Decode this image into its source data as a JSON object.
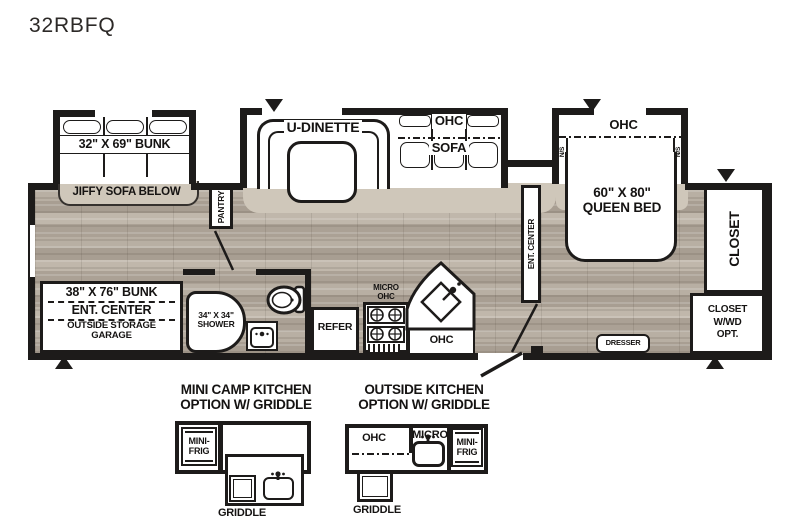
{
  "title": "32RBFQ",
  "plan": {
    "bunk_slide_label": "32\" X 69\" BUNK",
    "jiffy_sofa_label": "JIFFY SOFA BELOW",
    "pantry_label": "PANTRY",
    "udinette_label": "U-DINETTE",
    "sofa_ohc_label": "OHC",
    "sofa_label": "SOFA",
    "bed_ohc_label": "OHC",
    "ns_left_label": "N/S",
    "ns_right_label": "N/S",
    "queen_size_label": "60\" X 80\"",
    "queen_label": "QUEEN BED",
    "closet_label": "CLOSET",
    "closet_wwd_line1": "CLOSET",
    "closet_wwd_line2": "W/WD",
    "closet_wwd_line3": "OPT.",
    "garage_line1": "38\" X 76\" BUNK",
    "garage_line2": "ENT. CENTER",
    "garage_line3": "OUTSIDE STORAGE",
    "garage_line4": "GARAGE",
    "shower_line1": "34\" X 34\"",
    "shower_line2": "SHOWER",
    "refer_label": "REFER",
    "micro_line1": "MICRO",
    "micro_line2": "OHC",
    "kitchen_ohc_label": "OHC",
    "ent_center_label": "ENT. CENTER",
    "dresser_label": "DRESSER"
  },
  "options": {
    "mini_camp": {
      "title_line1": "MINI CAMP KITCHEN",
      "title_line2": "OPTION W/ GRIDDLE",
      "mini_frig_line1": "MINI-",
      "mini_frig_line2": "FRIG",
      "griddle_label": "GRIDDLE"
    },
    "outside_kitchen": {
      "title_line1": "OUTSIDE KITCHEN",
      "title_line2": "OPTION W/ GRIDDLE",
      "ohc_label": "OHC",
      "micro_label": "MICRO",
      "mini_frig_line1": "MINI-",
      "mini_frig_line2": "FRIG",
      "griddle_label": "GRIDDLE"
    }
  },
  "colors": {
    "wall": "#1d1b1a",
    "carpet": "#cfc7ba",
    "wood": "#b2a89c",
    "white": "#ffffff"
  }
}
